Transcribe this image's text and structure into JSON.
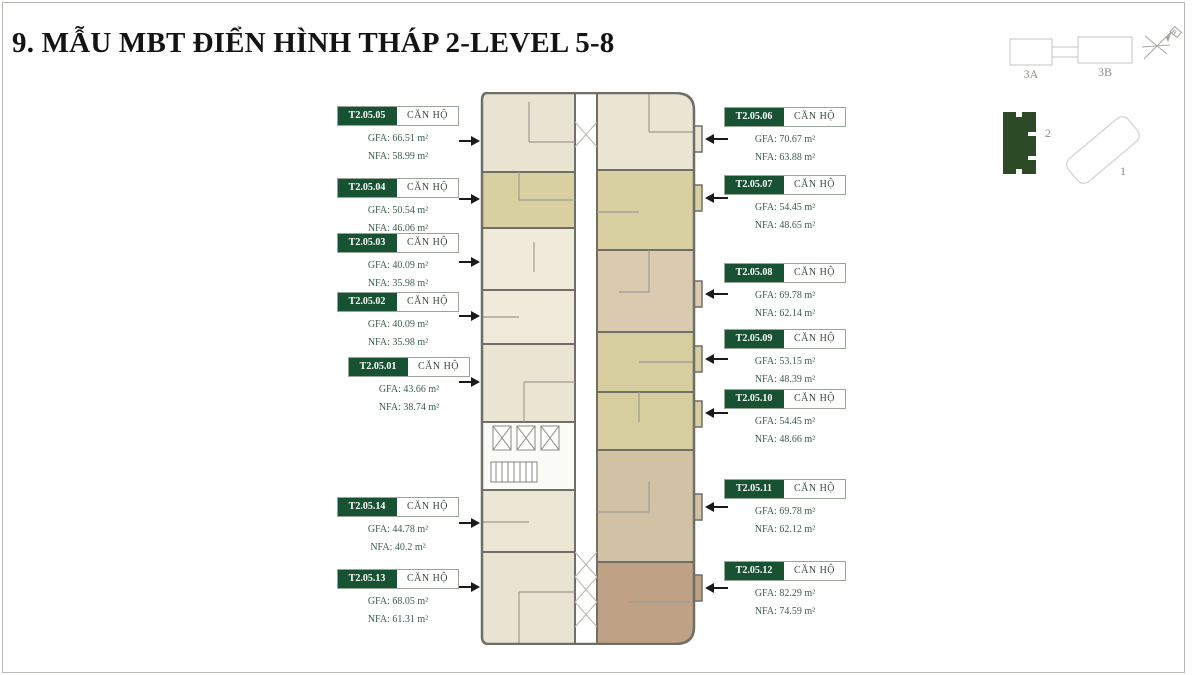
{
  "title": "9. MẪU MBT ĐIỂN HÌNH THÁP 2-LEVEL 5-8",
  "site_plan": {
    "block_3a": "3A",
    "block_3b": "3B",
    "tower_2": "2",
    "tower_1": "1",
    "compass": "B"
  },
  "units_left": [
    {
      "id": "T2.05.05",
      "type": "CĂN HỘ",
      "gfa": "GFA: 66.51 m²",
      "nfa": "NFA: 58.99 m²"
    },
    {
      "id": "T2.05.04",
      "type": "CĂN HỘ",
      "gfa": "GFA: 50.54 m²",
      "nfa": "NFA: 46.06 m²"
    },
    {
      "id": "T2.05.03",
      "type": "CĂN HỘ",
      "gfa": "GFA: 40.09 m²",
      "nfa": "NFA: 35.98 m²"
    },
    {
      "id": "T2.05.02",
      "type": "CĂN HỘ",
      "gfa": "GFA: 40.09 m²",
      "nfa": "NFA: 35.98 m²"
    },
    {
      "id": "T2.05.01",
      "type": "CĂN HỘ",
      "gfa": "GFA: 43.66 m²",
      "nfa": "NFA: 38.74 m²"
    },
    {
      "id": "T2.05.14",
      "type": "CĂN HỘ",
      "gfa": "GFA: 44.78 m²",
      "nfa": "NFA: 40.2 m²"
    },
    {
      "id": "T2.05.13",
      "type": "CĂN HỘ",
      "gfa": "GFA: 68.05 m²",
      "nfa": "NFA: 61.31 m²"
    }
  ],
  "units_right": [
    {
      "id": "T2.05.06",
      "type": "CĂN HỘ",
      "gfa": "GFA: 70.67 m²",
      "nfa": "NFA: 63.88 m²"
    },
    {
      "id": "T2.05.07",
      "type": "CĂN HỘ",
      "gfa": "GFA: 54.45 m²",
      "nfa": "NFA: 48.65 m²"
    },
    {
      "id": "T2.05.08",
      "type": "CĂN HỘ",
      "gfa": "GFA: 69.78 m²",
      "nfa": "NFA: 62.14 m²"
    },
    {
      "id": "T2.05.09",
      "type": "CĂN HỘ",
      "gfa": "GFA: 53.15 m²",
      "nfa": "NFA: 48.39 m²"
    },
    {
      "id": "T2.05.10",
      "type": "CĂN HỘ",
      "gfa": "GFA: 54.45 m²",
      "nfa": "NFA: 48.66 m²"
    },
    {
      "id": "T2.05.11",
      "type": "CĂN HỘ",
      "gfa": "GFA: 69.78 m²",
      "nfa": "NFA: 62.12 m²"
    },
    {
      "id": "T2.05.12",
      "type": "CĂN HỘ",
      "gfa": "GFA: 82.29 m²",
      "nfa": "NFA: 74.59 m²"
    }
  ],
  "colors": {
    "accent_green": "#175233",
    "tower_green": "#2d4a26",
    "wall_gray": "#6f6f68",
    "unit_cream": "#e9e3d1",
    "unit_khaki": "#d8d0a0",
    "unit_tan": "#d9cab0",
    "unit_brown": "#bfa285",
    "label_text_green": "#3e5f4c"
  }
}
